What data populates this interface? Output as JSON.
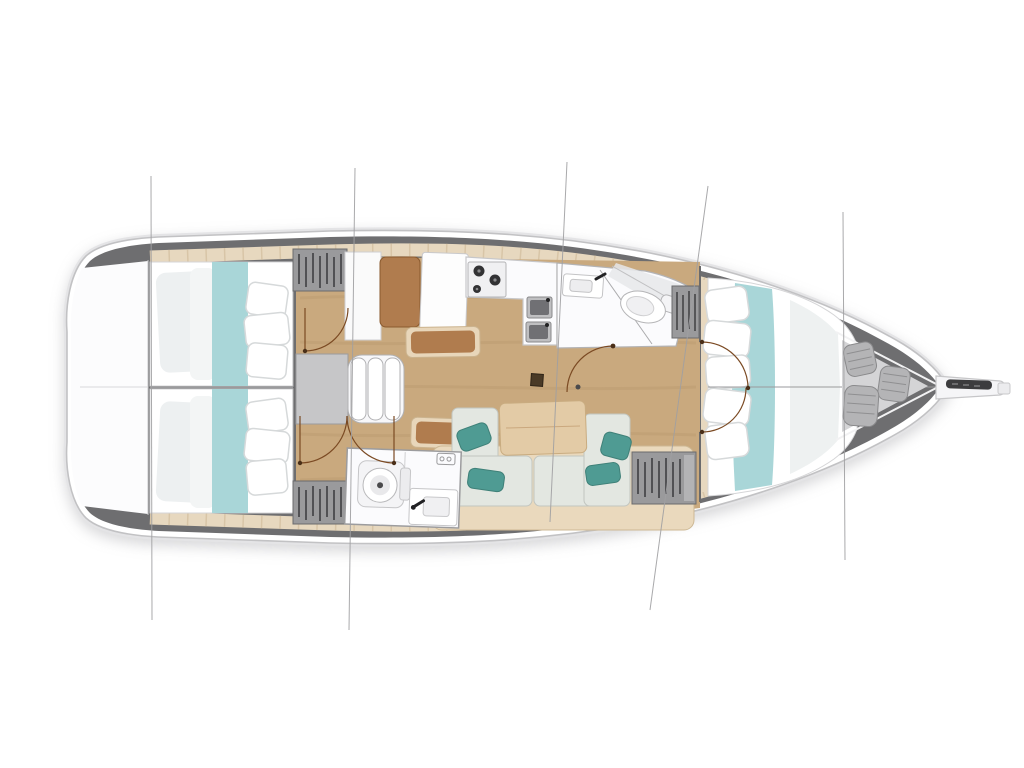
{
  "page": {
    "background": "#ffffff",
    "description": "Sailing yacht interior layout plan, top-down deck view, bow pointing right, no visible text"
  },
  "palette": {
    "hull_outline": "#c2c2c4",
    "hull_halo": "#e4e4e6",
    "bulwark_gray": "#6e6e70",
    "deck_teak": "#e7d8bf",
    "deck_seam": "#d5c1a1",
    "transom_white": "#fcfcfd",
    "floor_wood": "#c9a97e",
    "floor_grain": "#8a6a44",
    "berth_white": "#ffffff",
    "berth_shade": "#edf0f1",
    "berth_runner_teal": "#a9d6d8",
    "pillow_white": "#ffffff",
    "pillow_edge": "#d6d9da",
    "pillow_teal": "#4f9b93",
    "sofa_cushion": "#e3e7e1",
    "sofa_base": "#ead9bd",
    "table_wood": "#e3cba6",
    "seat_brown": "#b07c4e",
    "seat_frame_tan": "#e8d6ba",
    "locker_gray": "#9a9a9c",
    "locker_hatch": "#3f3f42",
    "fixture_white": "#fbfbfd",
    "fixture_edge": "#b9b9bb",
    "companionway_gray": "#c6c6c8",
    "bow_locker": "#d4d4d6",
    "fender_gray": "#b4b4b6",
    "anchor_slot": "#3c3c3e",
    "door_swing": "#7b4a23",
    "door_pivot": "#4a2f18",
    "section_line": "#a0a0a2",
    "centerline": "#9a9a9c"
  },
  "boat": {
    "view": "deck-plan",
    "bow_direction": "right",
    "areas": [
      {
        "id": "transom",
        "label": "Stern transom platform"
      },
      {
        "id": "aft-cabin-port",
        "label": "Aft double cabin (port)"
      },
      {
        "id": "aft-cabin-starboard",
        "label": "Aft double cabin (starboard)"
      },
      {
        "id": "companionway",
        "label": "Companionway steps and engine box"
      },
      {
        "id": "nav-station",
        "label": "Chart table and seat"
      },
      {
        "id": "galley",
        "label": "Galley with stove and twin sinks"
      },
      {
        "id": "aft-head",
        "label": "Aft head with toilet and sink"
      },
      {
        "id": "salon",
        "label": "Salon sofa and dining table"
      },
      {
        "id": "forward-head",
        "label": "Forward head with shower and toilet"
      },
      {
        "id": "forward-cabin",
        "label": "Forward double cabin"
      },
      {
        "id": "bow-locker",
        "label": "Bow sail locker with fenders"
      },
      {
        "id": "bowsprit",
        "label": "Bowsprit and anchor roller"
      }
    ]
  }
}
